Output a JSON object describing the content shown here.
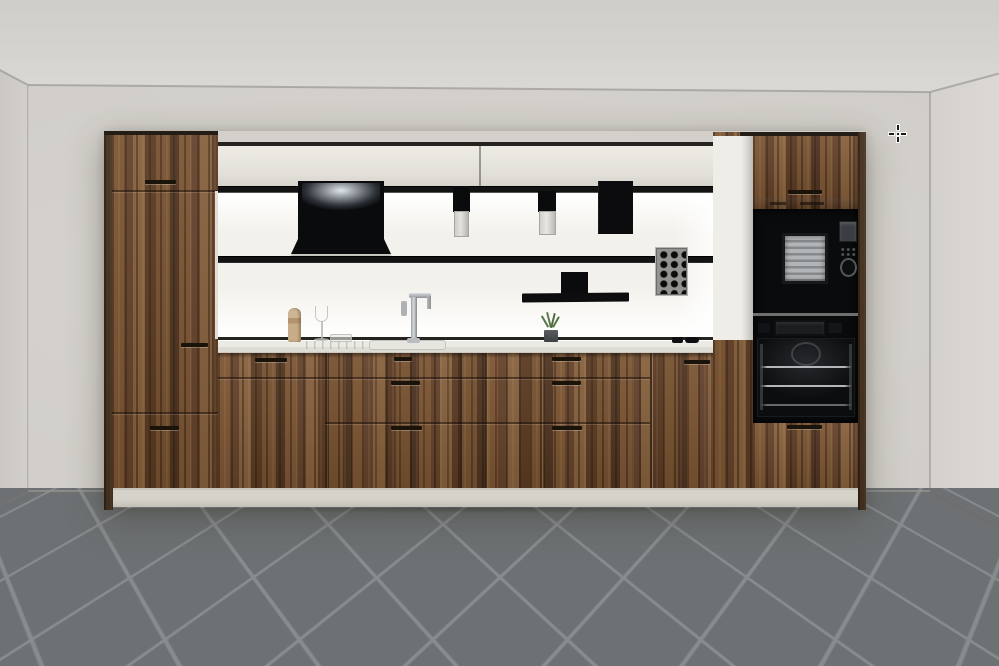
{
  "app": {
    "name": "Kitchen Planner 3D Preview",
    "view_mode": "3D room view"
  },
  "cursor": {
    "type": "crosshair",
    "x": 897,
    "y": 133
  },
  "colors": {
    "wall": "#d7d4cf",
    "wall_left": "#cbc8c3",
    "wall_right": "#dcd9d4",
    "floor_tile": "#6d7173",
    "floor_grout": "#888c8f",
    "wood": "#6f4c2e",
    "cabinet_light": "#e7e5de",
    "backsplash": "#f3f1eb",
    "rail": "#131313",
    "appliance": "#0a0b0d",
    "counter": "#eceae4",
    "plinth": "#d5d2c9"
  },
  "scene": {
    "elements": {
      "ceiling": "Ceiling",
      "wall_left": "Left wall",
      "wall_back": "Back wall",
      "wall_right": "Right wall",
      "floor": "Gray diagonal tile floor",
      "tall_unit_left": "Tall wood cabinet (3 fronts)",
      "upper_cabinets": "Wall cabinets, light fronts",
      "hood": "Black extractor hood with light",
      "rail_top": "Upper backsplash rail",
      "rail_bottom": "Lower backsplash rail",
      "canister_1": "Rail canister",
      "canister_2": "Rail canister",
      "towel": "Black towel on rail",
      "pegboard": "Perforated rail panel",
      "shelf": "Black rail shelf",
      "backsplash": "Illuminated backsplash",
      "counter": "Light worktop",
      "sink": "Inset sink",
      "faucet": "Chrome faucet",
      "pepper_mill": "Pepper mill",
      "wine_glass": "Glass",
      "glass_dish": "Glass dish",
      "plant": "Potted plant",
      "counter_objects": "Small black objects on worktop",
      "base_cabinets": "Wood base cabinets and drawers",
      "end_panel": "Light end panel",
      "tall_unit_right": "Tall appliance column",
      "top_door_right": "Wall door above microwave",
      "microwave": "Built-in black microwave",
      "oven": "Built-in black oven",
      "bottom_door_right": "Door below oven",
      "plinth": "Plinth"
    }
  }
}
